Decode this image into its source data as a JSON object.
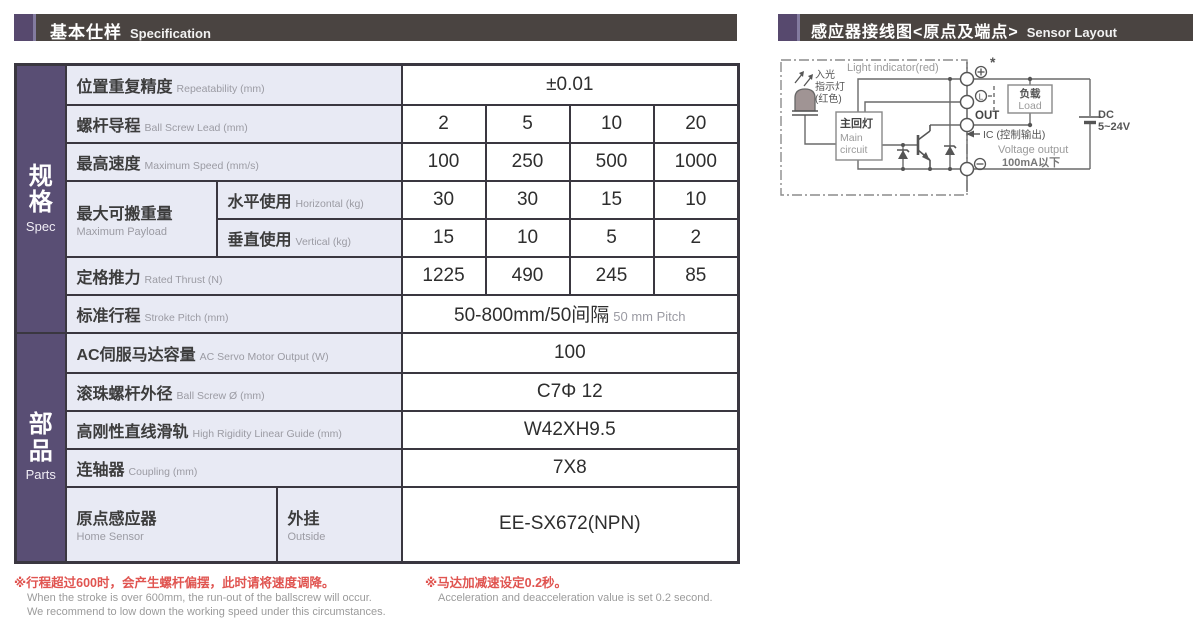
{
  "colors": {
    "accent_purple": "#57496e",
    "group_purple": "#594e74",
    "header_bar": "#4a4441",
    "label_cell_bg": "#e8eaf4",
    "table_border": "#3a3740",
    "note_red": "#e05450",
    "muted_gray": "#9b9ba3"
  },
  "headers": {
    "spec": {
      "zh": "基本仕样",
      "en": "Specification"
    },
    "sensor": {
      "zh": "感应器接线图<原点及端点>",
      "en": "Sensor Layout"
    }
  },
  "table": {
    "groups": [
      {
        "zh": "规格",
        "en": "Spec"
      },
      {
        "zh": "部品",
        "en": "Parts"
      }
    ],
    "rows": [
      {
        "zh": "位置重复精度",
        "en": "Repeatability (mm)",
        "value": "±0.01"
      },
      {
        "zh": "螺杆导程",
        "en": "Ball Screw Lead (mm)",
        "values": [
          "2",
          "5",
          "10",
          "20"
        ]
      },
      {
        "zh": "最高速度",
        "en": "Maximum Speed (mm/s)",
        "values": [
          "100",
          "250",
          "500",
          "1000"
        ]
      },
      {
        "zh": "最大可搬重量",
        "en": "Maximum Payload",
        "sub": {
          "zh": "水平使用",
          "en": "Horizontal (kg)"
        },
        "values": [
          "30",
          "30",
          "15",
          "10"
        ]
      },
      {
        "sub": {
          "zh": "垂直使用",
          "en": "Vertical (kg)"
        },
        "values": [
          "15",
          "10",
          "5",
          "2"
        ]
      },
      {
        "zh": "定格推力",
        "en": "Rated Thrust (N)",
        "values": [
          "1225",
          "490",
          "245",
          "85"
        ]
      },
      {
        "zh": "标准行程",
        "en": "Stroke Pitch (mm)",
        "value": "50-800mm/50间隔",
        "value_en": "50 mm Pitch"
      },
      {
        "zh": "AC伺服马达容量",
        "en": "AC Servo Motor Output (W)",
        "value": "100"
      },
      {
        "zh": "滚珠螺杆外径",
        "en": "Ball Screw Ø (mm)",
        "value": "C7Φ 12"
      },
      {
        "zh": "高刚性直线滑轨",
        "en": "High Rigidity Linear Guide (mm)",
        "value": "W42XH9.5"
      },
      {
        "zh": "连轴器",
        "en": "Coupling (mm)",
        "value": "7X8"
      },
      {
        "zh": "原点感应器",
        "en": "Home Sensor",
        "sub": {
          "zh": "外挂",
          "en": "Outside"
        },
        "value": "EE-SX672(NPN)"
      }
    ]
  },
  "footnotes": [
    {
      "zh": "※行程超过600时，会产生螺杆偏摆，此时请将速度调降。",
      "en1": "When the stroke is over 600mm, the run-out of the ballscrew will occur.",
      "en2": "We recommend to low down the working speed under this circumstances."
    },
    {
      "zh": "※马达加减速设定0.2秒。",
      "en1": "Acceleration and deacceleration value is set 0.2 second."
    }
  ],
  "diagram": {
    "light_zh1": "入光",
    "light_zh2": "指示灯",
    "light_zh3": "(红色)",
    "light_en": "Light indicator(red)",
    "main_zh": "主回灯",
    "main_en1": "Main",
    "main_en2": "circuit",
    "terminal_plus_note": "*",
    "terminal_l": "L",
    "out": "OUT",
    "ic": "IC (控制输出)",
    "voltage_output": "Voltage output",
    "current_limit": "100mA以下",
    "load_zh": "负载",
    "load_en": "Load",
    "dc": "DC",
    "dc_range": "5~24V"
  }
}
